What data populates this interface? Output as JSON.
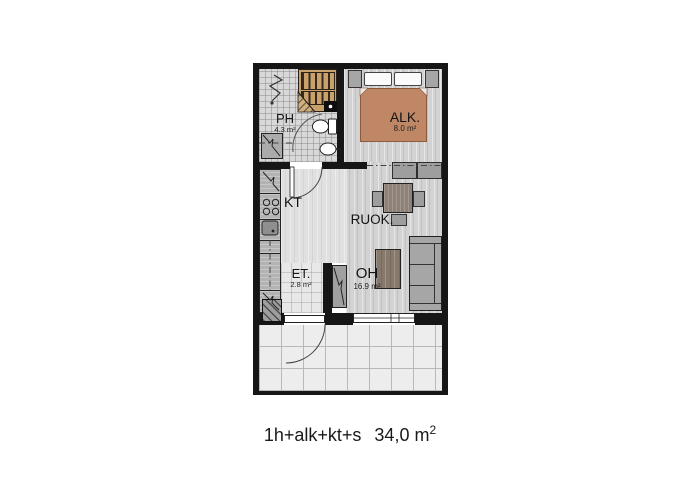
{
  "caption": {
    "layout_label": "1h+alk+kt+s",
    "total_area": "34,0 m",
    "area_superscript": "2"
  },
  "rooms": {
    "ph": {
      "name": "PH",
      "area": "4.3 m²"
    },
    "alk": {
      "name": "ALK.",
      "area": "8.0 m²"
    },
    "kt": {
      "name": "KT"
    },
    "ruok": {
      "name": "RUOK."
    },
    "et": {
      "name": "ET.",
      "area": "2.8 m²"
    },
    "oh": {
      "name": "OH",
      "area": "16.9 m²"
    }
  },
  "colors": {
    "wall": "#161616",
    "bed_cover": "#bf8765",
    "sauna_wood": "#c9a16b",
    "furniture_gray": "#a6a6a6",
    "table_wood": "#8d8178",
    "coffee_table_wood": "#877a6d",
    "floor_wood": "#d2d2d2",
    "floor_kitchen": "#e0e0e0",
    "floor_entry": "#e8e8e8",
    "floor_bath": "#d8d8d8",
    "floor_balcony": "#ededed",
    "line": "#333333"
  }
}
